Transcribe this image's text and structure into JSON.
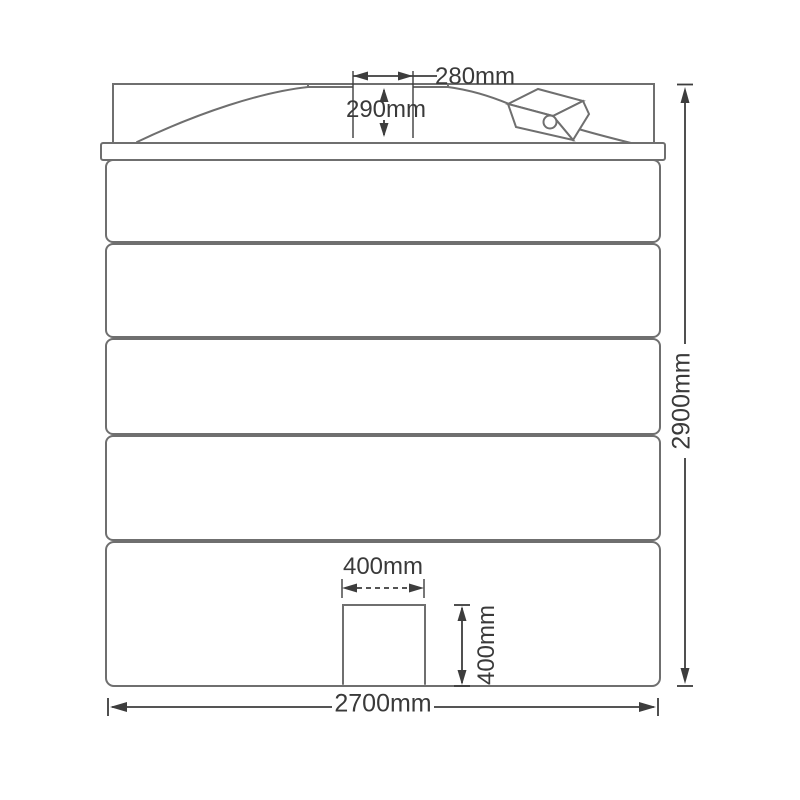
{
  "diagram": {
    "type": "technical-drawing",
    "subject": "vertical storage tank - front elevation with dimensions",
    "colors": {
      "outline": "#6f6f6f",
      "dimension": "#3d3d3d",
      "background": "#ffffff"
    },
    "labels": {
      "lid_width": "280mm",
      "neck_height": "290mm",
      "overall_height": "2900mm",
      "sump_width": "400mm",
      "sump_height": "400mm",
      "overall_width": "2700mm"
    },
    "features": {
      "body_bands": 5,
      "lid": "central manway opening on dome",
      "fitting": "isometric outlet box with circular port on dome right side",
      "sump": "rectangular recess at base centre"
    }
  }
}
